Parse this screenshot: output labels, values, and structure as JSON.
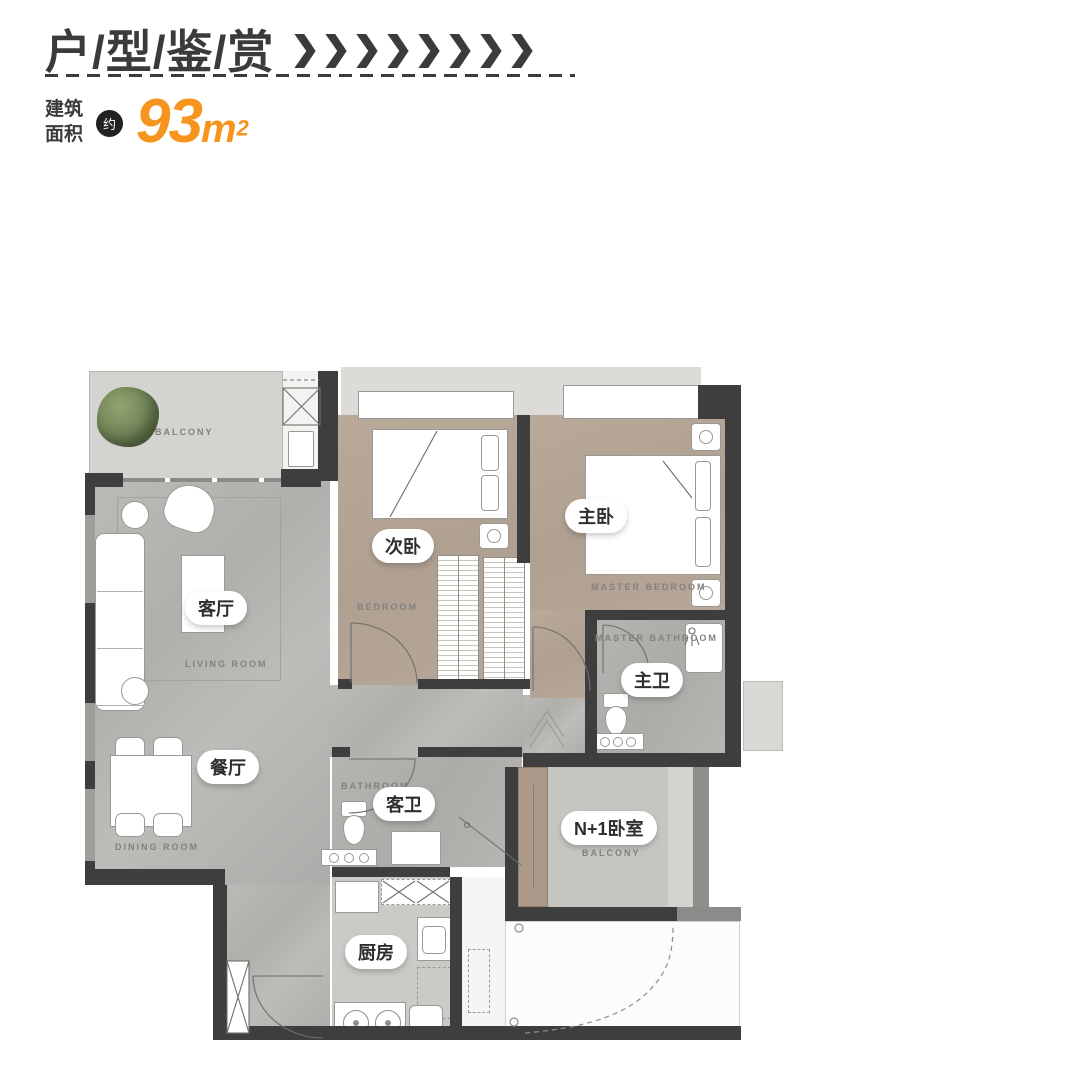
{
  "header": {
    "title": "户/型/鉴/赏",
    "chevrons": "❯❯❯❯❯❯❯❯",
    "area_label_line1": "建筑",
    "area_label_line2": "面积",
    "approx_badge": "约",
    "area_value": "93",
    "area_unit_base": "m",
    "area_unit_sup": "2"
  },
  "colors": {
    "accent_orange": "#F7941E",
    "ink": "#3B3B3B",
    "wall": "#3E3E3E",
    "marble_floor": "#B6B5B2",
    "wood_floor": "#B2A294",
    "balcony_floor": "#D4D3CF"
  },
  "rooms": {
    "balcony": {
      "label_en": "BALCONY"
    },
    "living": {
      "label_zh": "客厅",
      "label_en": "LIVING ROOM"
    },
    "dining": {
      "label_zh": "餐厅",
      "label_en": "DINING ROOM"
    },
    "bedroom2": {
      "label_zh": "次卧",
      "label_en": "BEDROOM"
    },
    "master_bedroom": {
      "label_zh": "主卧",
      "label_en": "MASTER BEDROOM"
    },
    "master_bath": {
      "label_zh": "主卫",
      "label_en": "MASTER BATHROOM"
    },
    "guest_bath": {
      "label_zh": "客卫",
      "label_en": "BATHROOM"
    },
    "kitchen": {
      "label_zh": "厨房"
    },
    "n1_bedroom": {
      "label_zh": "N+1卧室",
      "label_en": "BALCONY"
    }
  }
}
